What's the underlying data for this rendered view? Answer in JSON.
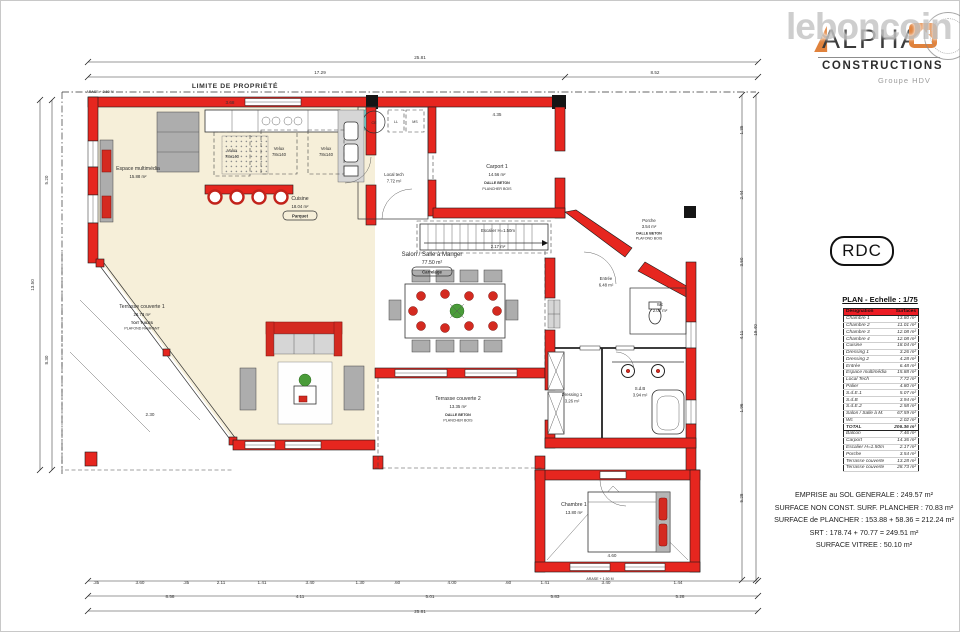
{
  "watermark": "leboncoin",
  "logo": {
    "alpha": "ALPHA",
    "constructions": "CONSTRUCTIONS",
    "group": "Groupe HDV"
  },
  "floor_badge": "RDC",
  "surface_table": {
    "title": "PLAN - Echelle : 1/75",
    "headers": {
      "designation": "Désignation",
      "surface": "Surfaces"
    },
    "rows": [
      {
        "label": "Chambre 1",
        "value": "13.80 m²"
      },
      {
        "label": "Chambre 2",
        "value": "11.01 m²"
      },
      {
        "label": "Chambre 3",
        "value": "12.08 m²"
      },
      {
        "label": "Chambre 4",
        "value": "12.08 m²"
      },
      {
        "label": "Cuisine",
        "value": "18.04 m²"
      },
      {
        "label": "Dressing 1",
        "value": "3.26 m²"
      },
      {
        "label": "Dressing 2",
        "value": "4.28 m²"
      },
      {
        "label": "Entrée",
        "value": "6.48 m²"
      },
      {
        "label": "Espace multimédia",
        "value": "15.88 m²"
      },
      {
        "label": "Local Tech",
        "value": "7.72 m²"
      },
      {
        "label": "Palier",
        "value": "4.80 m²"
      },
      {
        "label": "S.d.E.1",
        "value": "5.07 m²"
      },
      {
        "label": "S.d.B",
        "value": "3.94 m²"
      },
      {
        "label": "S.d.E.2",
        "value": "2.58 m²"
      },
      {
        "label": "Salon / Salle à M.",
        "value": "67.59 m²"
      },
      {
        "label": "Wc",
        "value": "2.02 m²"
      }
    ],
    "total": {
      "label": "TOTAL",
      "value": "206.36 m²"
    },
    "annex_rows": [
      {
        "label": "Balcon",
        "value": "7.46 m²"
      },
      {
        "label": "Carport",
        "value": "14.36 m²"
      },
      {
        "label": "Escalier H=1.50m",
        "value": "2.17 m²"
      },
      {
        "label": "Porche",
        "value": "3.54 m²"
      },
      {
        "label": "Terrasse couverte",
        "value": "13.28 m²"
      },
      {
        "label": "Terrasse couverte",
        "value": "28.73 m²"
      }
    ]
  },
  "summary": {
    "lines": [
      "EMPRISE au SOL GENERALE : 249.57 m²",
      "SURFACE NON CONST. SURF. PLANCHER : 70.83 m²",
      "SURFACE de PLANCHER : 153.88 + 58.36 = 212.24 m²",
      "SRT : 178.74 + 70.77 = 249.51 m²",
      "SURFACE VITREE : 50.10 m²"
    ]
  },
  "plan": {
    "property_line_label": "LIMITE DE PROPRIÉTÉ",
    "arase_top": "ARASE + 2.50 M",
    "arase_bottom": "ARASE + 1.50 M",
    "labels": {
      "velux_line1": "Velux",
      "velux_line2": "78x140",
      "ll": "LL",
      "ms": "MS",
      "ce": "CE"
    },
    "rooms": {
      "espace_multimedia": {
        "name": "Espace multimédia",
        "area": "15.88 m²"
      },
      "cuisine": {
        "name": "Cuisine",
        "area": "18.04 m²",
        "floor": "Parquet"
      },
      "local_tech": {
        "name": "Local tech",
        "area": "7.72 m²"
      },
      "carport": {
        "name": "Carport 1",
        "area": "14.56 m²",
        "note1": "DALLE BETON",
        "note2": "PLANCHER BOIS"
      },
      "porche": {
        "name": "Porche",
        "area": "3.54 m²",
        "note1": "DALLE BETON",
        "note2": "PLAFOND BOIS"
      },
      "entree": {
        "name": "Entrée",
        "area": "6.48 m²"
      },
      "wc": {
        "name": "Wc",
        "area": "2.02 m²"
      },
      "salon": {
        "name": "Salon / Salle à Manger",
        "area": "77.50 m²",
        "floor": "Carrelage"
      },
      "escalier": {
        "name": "Escalier H=1.50m",
        "area": "2.17 m²"
      },
      "dressing": {
        "name": "Dressing 1",
        "area": "3.26 m²"
      },
      "sdb": {
        "name": "S.d.B",
        "area": "3.94 m²"
      },
      "chambre1": {
        "name": "Chambre 1",
        "area": "13.80 m²"
      },
      "terrasse1": {
        "name": "Terrasse couverte 1",
        "area": "28.73 m²",
        "note1": "TOIT TUILES",
        "note2": "PLAFOND RAMPANT"
      },
      "terrasse2": {
        "name": "Terrasse couverte 2",
        "area": "13.35 m²",
        "note1": "DALLE BETON",
        "note2": "PLANCHER BOIS"
      }
    },
    "dims": [
      {
        "t": "25.81",
        "x": 420,
        "y": 59
      },
      {
        "t": "17.29",
        "x": 320,
        "y": 74
      },
      {
        "t": "8.52",
        "x": 655,
        "y": 74
      },
      {
        "t": "13.50",
        "x": 34,
        "y": 285,
        "r": 1
      },
      {
        "t": "5.20",
        "x": 48,
        "y": 180,
        "r": 1
      },
      {
        "t": "8.30",
        "x": 48,
        "y": 360,
        "r": 1
      },
      {
        "t": "19.40",
        "x": 757,
        "y": 330,
        "r": 1
      },
      {
        "t": "1.35",
        "x": 743,
        "y": 130,
        "r": 1
      },
      {
        "t": "2.44",
        "x": 743,
        "y": 195,
        "r": 1
      },
      {
        "t": "3.50",
        "x": 743,
        "y": 262,
        "r": 1
      },
      {
        "t": "4.11",
        "x": 743,
        "y": 335,
        "r": 1
      },
      {
        "t": "1.96",
        "x": 743,
        "y": 408,
        "r": 1
      },
      {
        "t": "5.28",
        "x": 743,
        "y": 498,
        "r": 1
      },
      {
        "t": ".35",
        "x": 96,
        "y": 584
      },
      {
        "t": "3.60",
        "x": 140,
        "y": 584
      },
      {
        "t": ".35",
        "x": 186,
        "y": 584
      },
      {
        "t": "2.11",
        "x": 221,
        "y": 584
      },
      {
        "t": "1.41",
        "x": 262,
        "y": 584
      },
      {
        "t": "3.40",
        "x": 310,
        "y": 584
      },
      {
        "t": "1.30",
        "x": 360,
        "y": 584
      },
      {
        "t": ".60",
        "x": 397,
        "y": 584
      },
      {
        "t": "4.00",
        "x": 452,
        "y": 584
      },
      {
        "t": ".60",
        "x": 508,
        "y": 584
      },
      {
        "t": "1.41",
        "x": 545,
        "y": 584
      },
      {
        "t": "3.40",
        "x": 606,
        "y": 584
      },
      {
        "t": "1.44",
        "x": 678,
        "y": 584
      },
      {
        "t": "8.58",
        "x": 170,
        "y": 598
      },
      {
        "t": "4.11",
        "x": 300,
        "y": 598
      },
      {
        "t": "5.01",
        "x": 430,
        "y": 598
      },
      {
        "t": "5.83",
        "x": 555,
        "y": 598
      },
      {
        "t": "5.28",
        "x": 680,
        "y": 598
      },
      {
        "t": "25.81",
        "x": 420,
        "y": 613
      },
      {
        "t": "4.60",
        "x": 612,
        "y": 557
      },
      {
        "t": "3.68",
        "x": 230,
        "y": 104
      },
      {
        "t": "4.35",
        "x": 497,
        "y": 116
      },
      {
        "t": "2.30",
        "x": 150,
        "y": 416
      }
    ]
  },
  "colors": {
    "wall_red": "#e6261f",
    "floor_beige": "#f6efd9",
    "table_header_red": "#ec1c24",
    "logo_orange": "#e0823c"
  }
}
